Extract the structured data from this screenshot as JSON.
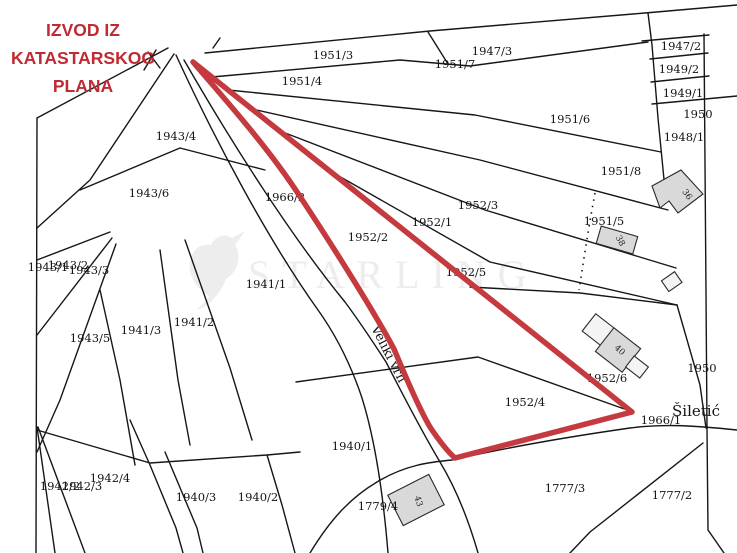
{
  "title": {
    "lines": [
      "IZVOD IZ",
      "KATASTARSKOG",
      "PLANA"
    ],
    "color": "#c02a33"
  },
  "watermark": {
    "text": "STARLING",
    "icon": "starling-bird-logo",
    "color": "#ededed"
  },
  "colors": {
    "highlight": "#c43a3e",
    "boundary": "#161616",
    "building_fill": "#d9d9d9",
    "building_light_fill": "#f4f4f4"
  },
  "map": {
    "parcel_labels": [
      {
        "text": "1951/3"
      },
      {
        "text": "1951/4"
      },
      {
        "text": "1947/3"
      },
      {
        "text": "1951/7"
      },
      {
        "text": "1947/2"
      },
      {
        "text": "1949/2"
      },
      {
        "text": "1949/1"
      },
      {
        "text": "1950"
      },
      {
        "text": "1948/1"
      },
      {
        "text": "1951/6"
      },
      {
        "text": "1951/8"
      },
      {
        "text": "1951/5"
      },
      {
        "text": "1943/4"
      },
      {
        "text": "1943/6"
      },
      {
        "text": "1966/2"
      },
      {
        "text": "1952/2"
      },
      {
        "text": "1952/1"
      },
      {
        "text": "1952/3"
      },
      {
        "text": "1952/5"
      },
      {
        "text": "1941/1"
      },
      {
        "text": "1943/1"
      },
      {
        "text": "1943/2"
      },
      {
        "text": "1943/3"
      },
      {
        "text": "1943/5"
      },
      {
        "text": "1941/3"
      },
      {
        "text": "1941/2"
      },
      {
        "text": "1952/6"
      },
      {
        "text": "1952/4"
      },
      {
        "text": "1966/1"
      },
      {
        "text": "1950"
      },
      {
        "text": "1940/1"
      },
      {
        "text": "1942/2"
      },
      {
        "text": "1942/3"
      },
      {
        "text": "1942/4"
      },
      {
        "text": "1940/3"
      },
      {
        "text": "1940/2"
      },
      {
        "text": "1779/4"
      },
      {
        "text": "1777/3"
      },
      {
        "text": "1777/2"
      }
    ],
    "street_labels": [
      {
        "text": "Veliki vrh"
      },
      {
        "text": "Šiletić"
      }
    ],
    "building_labels": [
      {
        "text": "36"
      },
      {
        "text": "38"
      },
      {
        "text": "40"
      },
      {
        "text": "43"
      }
    ]
  }
}
